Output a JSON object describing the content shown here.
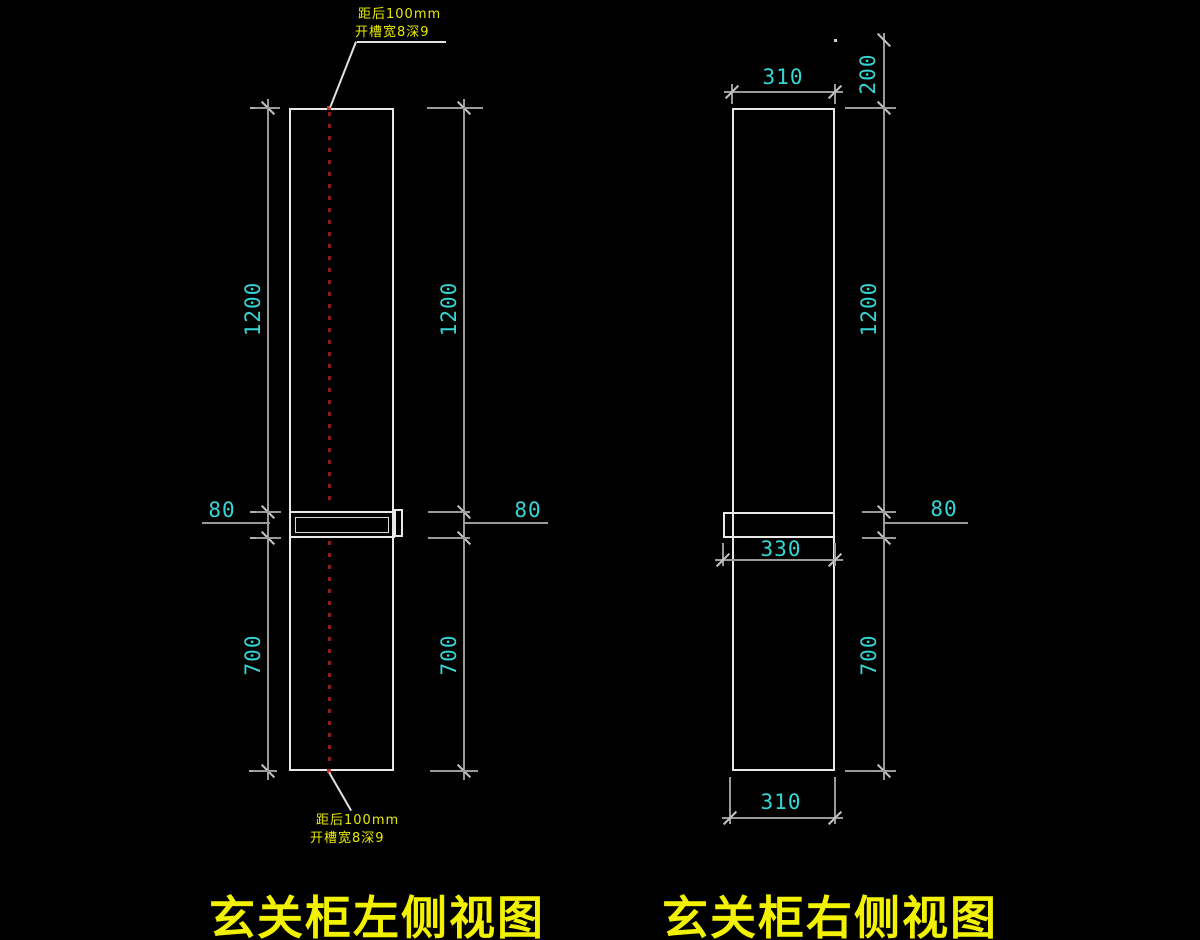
{
  "drawing": {
    "background": "#000000",
    "colors": {
      "object_line": "#e8e8e8",
      "dimension_line": "#9a9a9a",
      "dimension_text": "#35d6d6",
      "annotation_text": "#e9e900",
      "caption_text": "#f2f200",
      "centerline_red": "#8d1d1d"
    }
  },
  "left_view": {
    "caption": "玄关柜左侧视图",
    "top_annotation": {
      "line1": "距后100mm",
      "line2": "开槽宽8深9"
    },
    "bottom_annotation": {
      "line1": "距后100mm",
      "line2": "开槽宽8深9"
    },
    "dim_left_upper": "1200",
    "dim_left_shelf": "80",
    "dim_left_lower": "700",
    "dim_right_upper": "1200",
    "dim_right_shelf": "80",
    "dim_right_lower": "700"
  },
  "right_view": {
    "caption": "玄关柜右侧视图",
    "dim_top_depth": "310",
    "dim_top_offset": "200",
    "dim_right_upper": "1200",
    "dim_right_shelf": "80",
    "dim_right_lower": "700",
    "dim_shelf_depth": "330",
    "dim_bottom_depth": "310"
  }
}
